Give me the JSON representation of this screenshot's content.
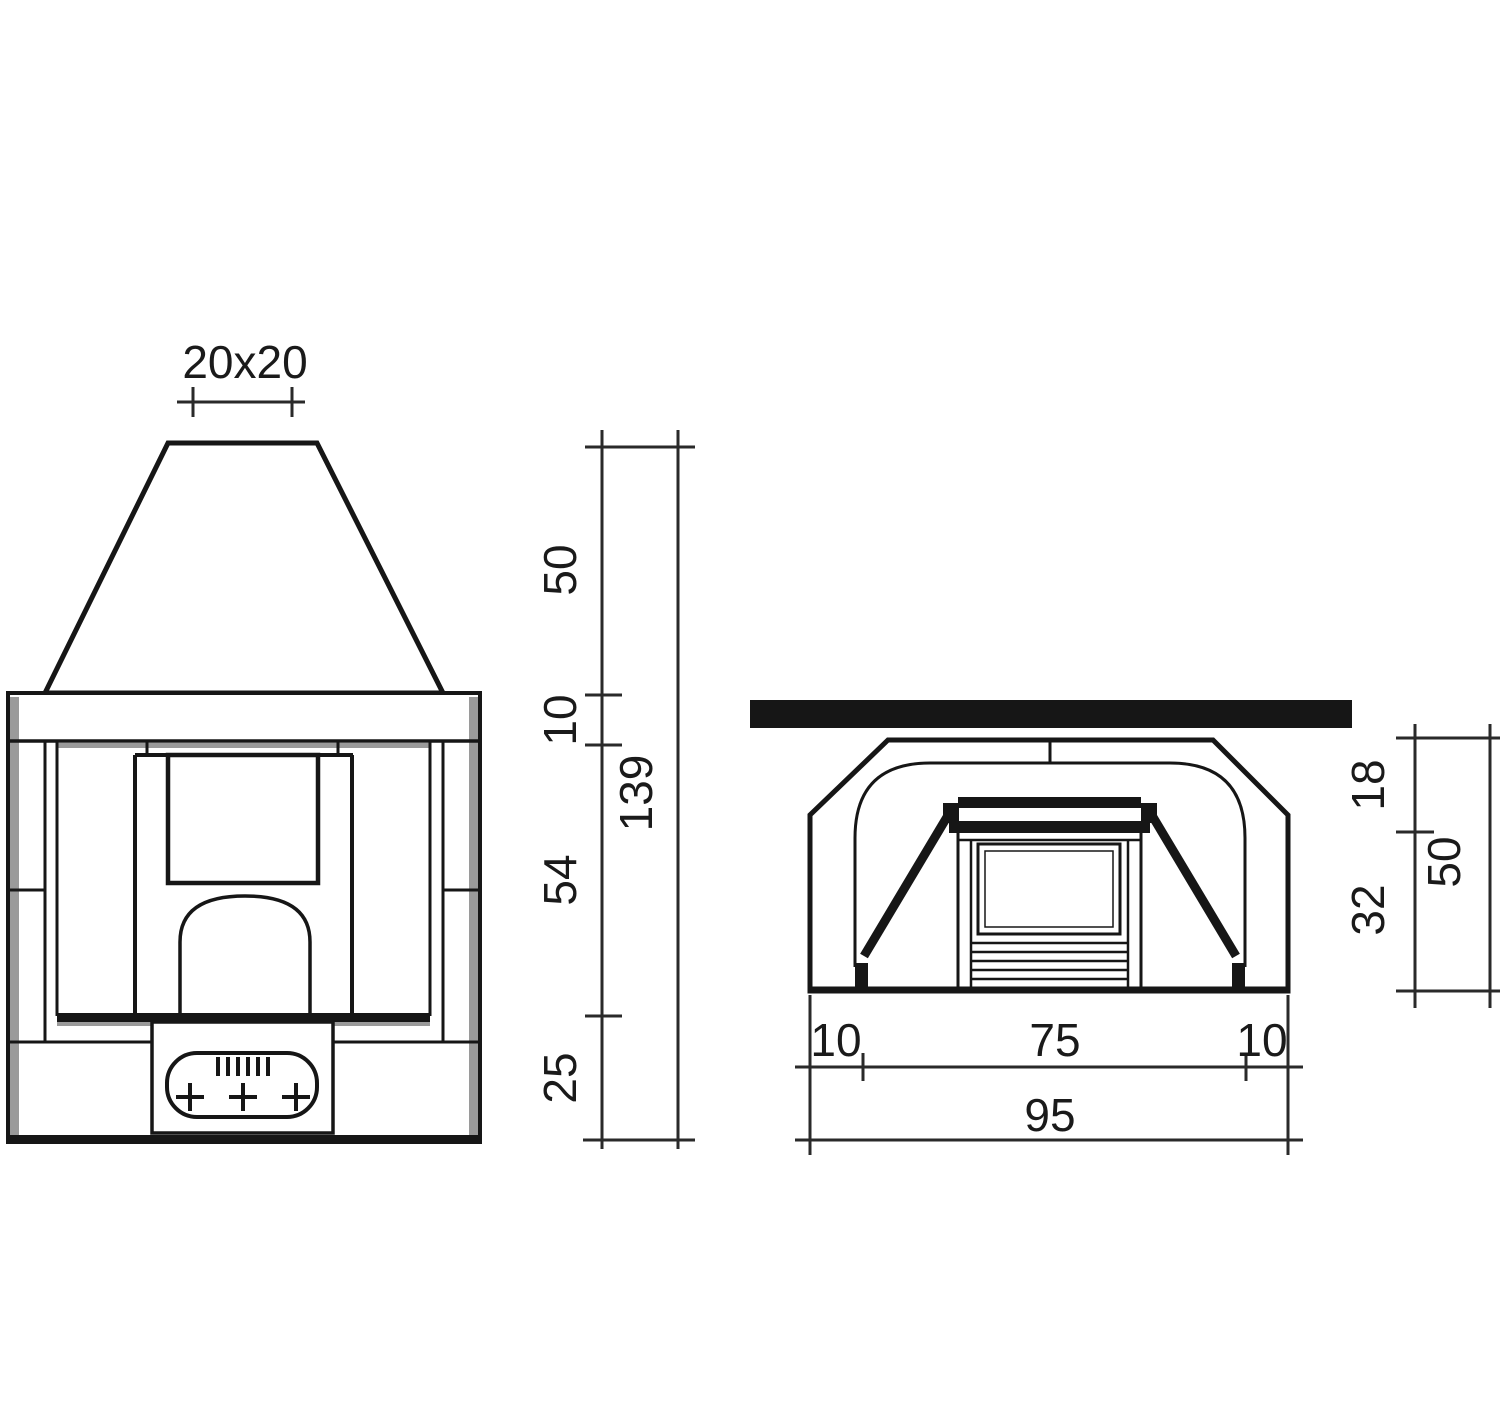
{
  "drawing": {
    "title": "fireplace-installation-dimension-drawing",
    "units_shown": false,
    "front_view": {
      "flue_size": "20x20",
      "hood_height": "50",
      "lintel_height": "10",
      "opening_height": "54",
      "base_height": "25",
      "total_height": "139"
    },
    "plan_view": {
      "front_depth": "18",
      "back_depth": "32",
      "total_depth": "50",
      "left_wall_width": "10",
      "opening_width": "75",
      "right_wall_width": "10",
      "total_width": "95"
    },
    "colors": {
      "line": "#161616",
      "dimension_line": "#2a2a2a",
      "shading": "#9a9a9a",
      "background": "#ffffff"
    }
  }
}
